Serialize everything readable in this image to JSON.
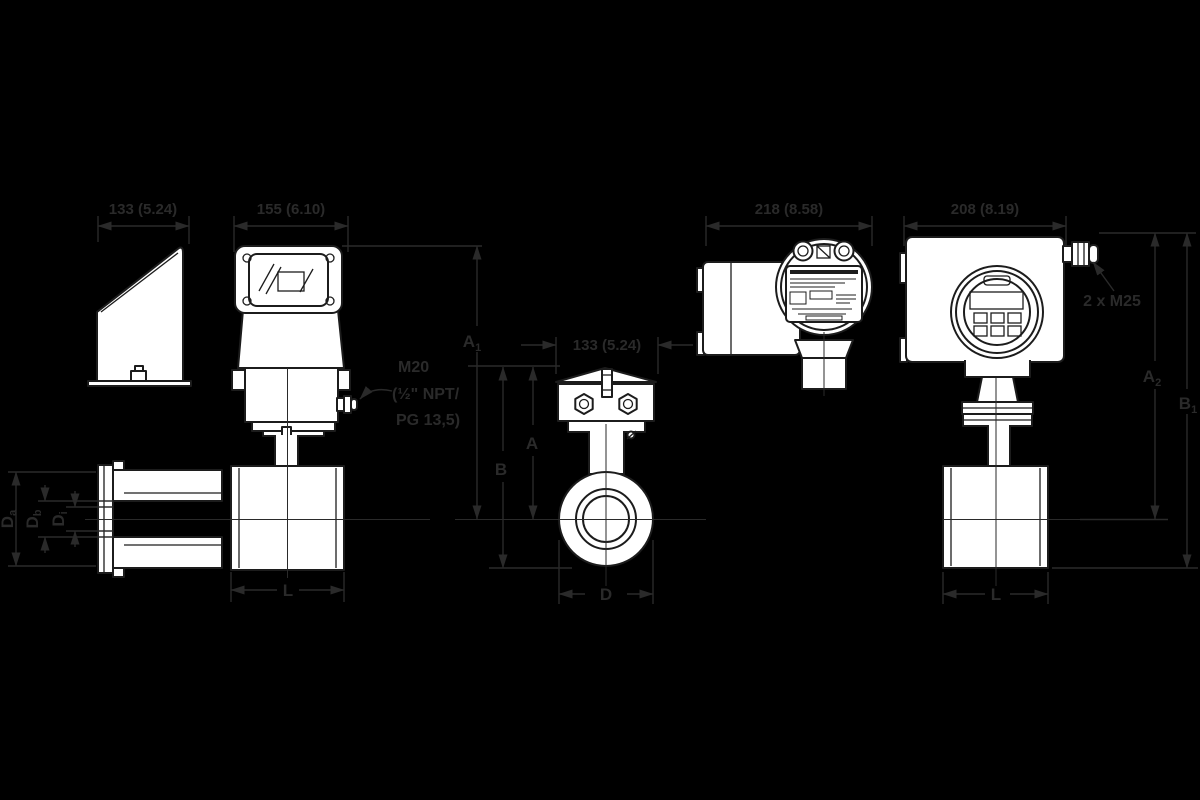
{
  "page": {
    "background": "#000000"
  },
  "drawing": {
    "line_color": "#1c1c1c",
    "dim_color": "#2a2a2a",
    "fill_color": "#ffffff"
  },
  "dimensions": {
    "side_width": "133 (5.24)",
    "front_width": "155 (6.10)",
    "wafer_width": "133 (5.24)",
    "rear_width": "218 (8.58)",
    "right_width": "208 (8.19)",
    "height_a1": {
      "main": "A",
      "sub": "1"
    },
    "height_a": "A",
    "height_b": "B",
    "height_a2": {
      "main": "A",
      "sub": "2"
    },
    "height_b1": {
      "main": "B",
      "sub": "1"
    },
    "length_left": "L",
    "outer_diameter": "D",
    "length_right": "L",
    "bore_da": {
      "main": "D",
      "sub": "a"
    },
    "bore_db": {
      "main": "D",
      "sub": "b"
    },
    "bore_di": {
      "main": "D",
      "sub": "i"
    }
  },
  "annotations": {
    "cable_entry_left_line1": "M20",
    "cable_entry_left_line2": "(½\" NPT/",
    "cable_entry_left_line3": "PG 13,5)",
    "cable_entry_right": "2 x M25"
  }
}
